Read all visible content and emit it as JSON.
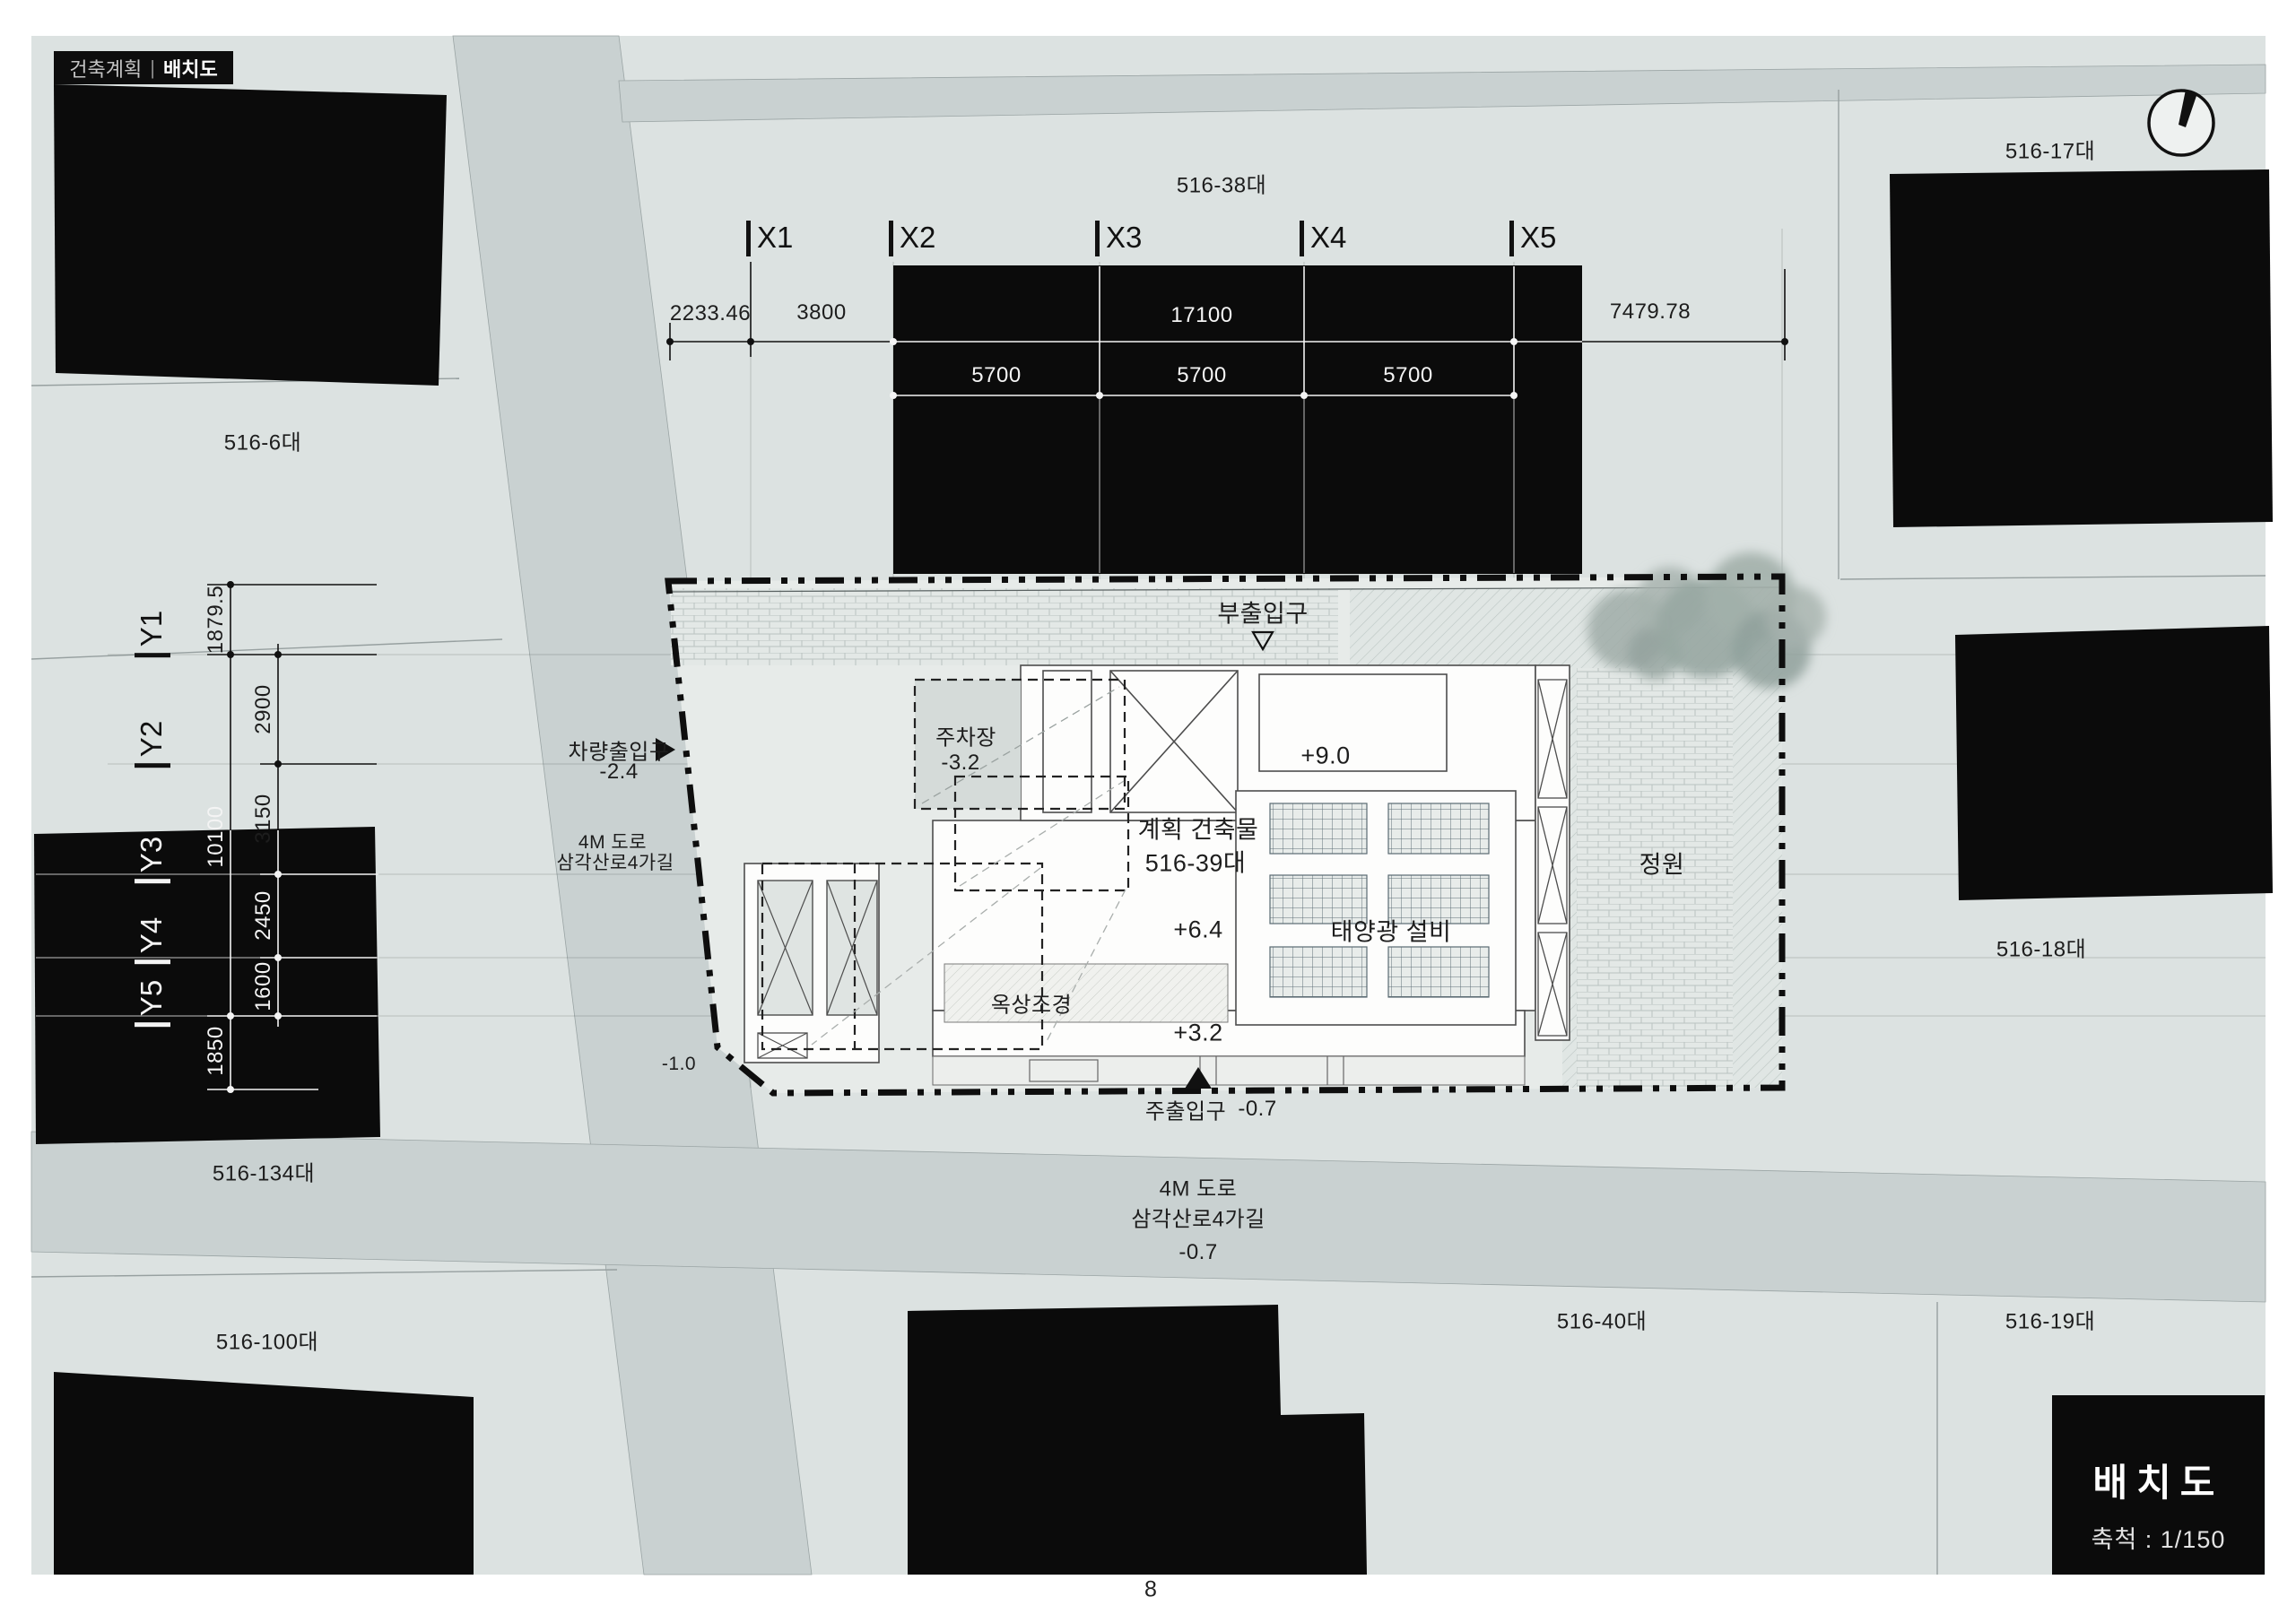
{
  "header": {
    "section": "건축계획",
    "divider": "|",
    "title": "배치도"
  },
  "title_block": {
    "name": "배치도",
    "scale": "축척 : 1/150"
  },
  "page_number": "8",
  "grid": {
    "x": [
      "X1",
      "X2",
      "X3",
      "X4",
      "X5"
    ],
    "y": [
      "Y1",
      "Y2",
      "Y3",
      "Y4",
      "Y5"
    ]
  },
  "dims": {
    "top": [
      "2233.46",
      "3800",
      "17100",
      "7479.78"
    ],
    "top_sub": [
      "5700",
      "5700",
      "5700"
    ],
    "left": [
      "1879.5",
      "2900",
      "3150",
      "2450",
      "1600",
      "1850"
    ],
    "left_total": "10100"
  },
  "parcels": {
    "p6": "516-6대",
    "p17": "516-17대",
    "p18": "516-18대",
    "p19": "516-19대",
    "p38": "516-38대",
    "p40": "516-40대",
    "p100": "516-100대",
    "p134": "516-134대"
  },
  "site": {
    "sub_entrance": "부출입구",
    "sub_entrance_marker": "▽",
    "main_entrance": "주출입구",
    "main_entrance_level": "-0.7",
    "main_entrance_marker": "▲",
    "vehicle_entrance": "차량출입구",
    "vehicle_entrance_level": "-2.4",
    "vehicle_entrance_marker": "▶",
    "parking": "주차장",
    "parking_level": "-3.2",
    "planned_building": "계획 건축물",
    "planned_parcel": "516-39대",
    "roof_top_level": "+9.0",
    "roof_mid_level": "+6.4",
    "roof_low_level": "+3.2",
    "solar": "태양광 설비",
    "roof_landscape": "옥상조경",
    "garden": "정원",
    "ground_level": "-1.0"
  },
  "roads": {
    "west": {
      "line1": "4M 도로",
      "line2": "삼각산로4가길"
    },
    "south": {
      "line1": "4M 도로",
      "line2": "삼각산로4가길",
      "level": "-0.7"
    }
  },
  "colors": {
    "ink": "#111111",
    "map_bg": "#dce2e1",
    "road": "#c9d1d1",
    "building": "#0b0b0b"
  }
}
